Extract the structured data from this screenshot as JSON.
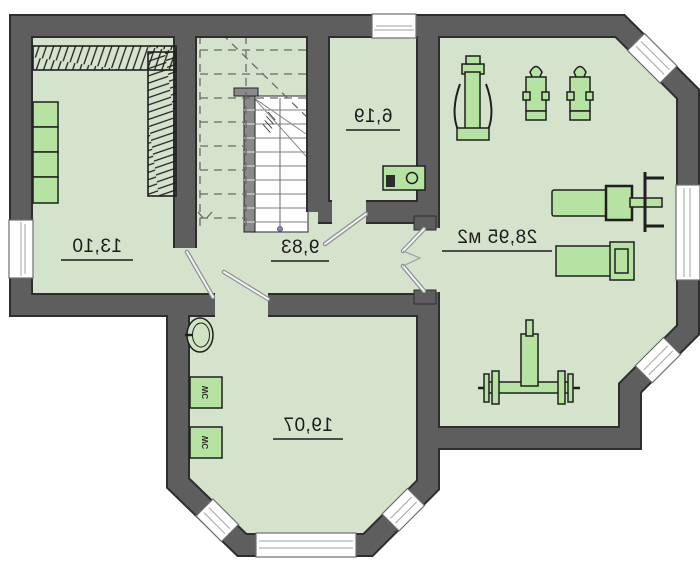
{
  "rooms": {
    "wardrobe_room": {
      "area_label": "13,10"
    },
    "hall": {
      "area_label": "9,83"
    },
    "utility_room": {
      "area_label": "6,19"
    },
    "gym": {
      "area_label": "28,95 м2"
    },
    "bedroom": {
      "area_label": "19,07"
    }
  },
  "fixtures": {
    "wc_box_1_label": "WC",
    "wc_box_2_label": "WC"
  },
  "equipment_names": [
    "press-machine",
    "exercise-bike",
    "exercise-bike",
    "bench-press",
    "workout-bench",
    "barbell-rack",
    "washing-machine",
    "washbasin",
    "wardrobe-rails",
    "wardrobe-cabinets",
    "staircase"
  ],
  "colors": {
    "wall": "#5e5e5e",
    "wall-outline": "#2e2e2e",
    "floor": "#d5e2cc",
    "furniture": "#b6e2a2",
    "window": "#ffffff"
  }
}
